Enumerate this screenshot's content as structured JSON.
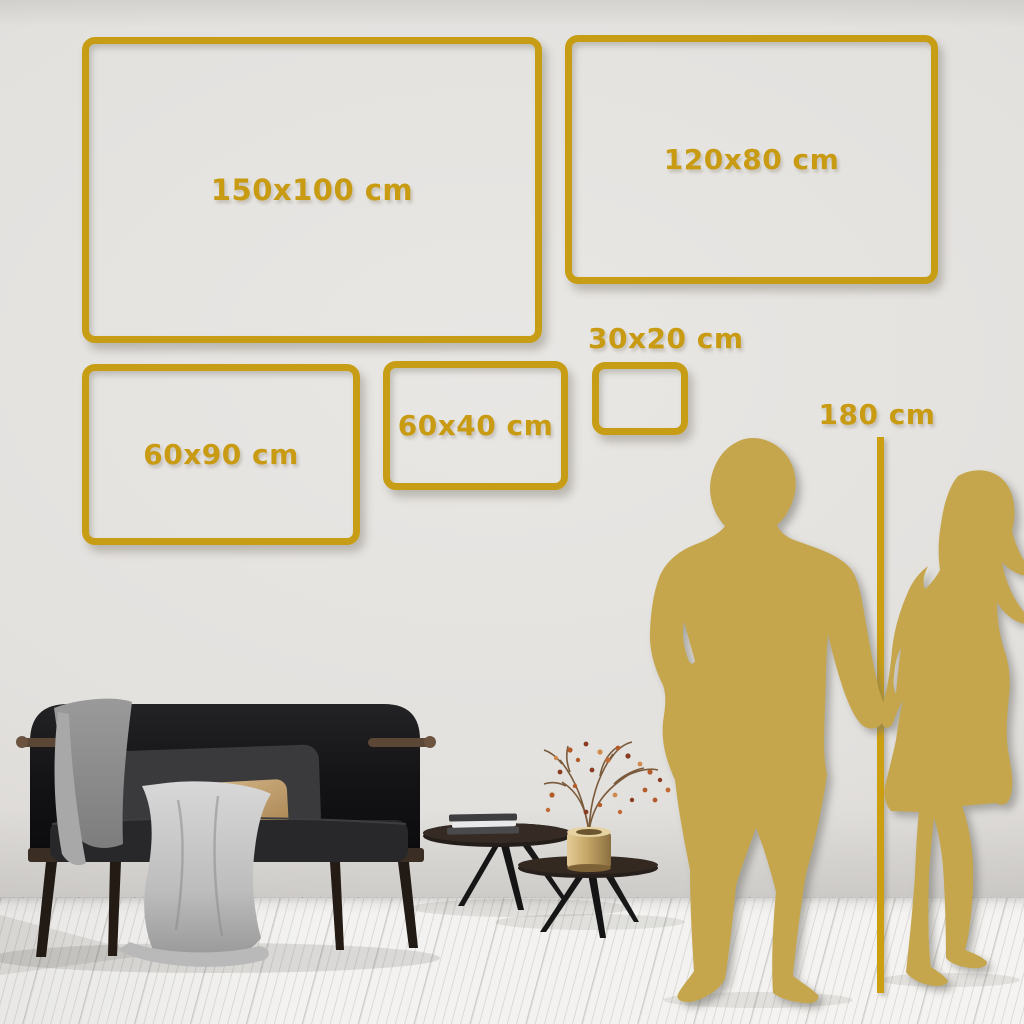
{
  "scene": {
    "description": "Canvas wall-art size guide in a living room",
    "unit": "cm"
  },
  "palette": {
    "accent_gold": "#C89D16",
    "silhouette_gold": "#C6A64D",
    "wall_gray": "#E3E1DE",
    "floor_white": "#F3F2F0"
  },
  "size_frames": [
    {
      "id": "150x100",
      "label": "150x100 cm"
    },
    {
      "id": "120x80",
      "label": "120x80 cm"
    },
    {
      "id": "60x90",
      "label": "60x90 cm"
    },
    {
      "id": "60x40",
      "label": "60x40 cm"
    },
    {
      "id": "30x20",
      "label": "30x20 cm"
    }
  ],
  "height_reference": {
    "label": "180 cm"
  },
  "illustrations": {
    "couple": "man-and-woman-holding-hands-silhouette",
    "sofa": "dark-velvet-sofa-with-gray-throw-blanket",
    "pillows": [
      "dark-gray-back-cushion",
      "beige-lumbar-pillow"
    ],
    "tables": "round-nesting-coffee-tables",
    "books": "stacked-books",
    "vase": "brass-vase-with-dried-berry-branch"
  }
}
